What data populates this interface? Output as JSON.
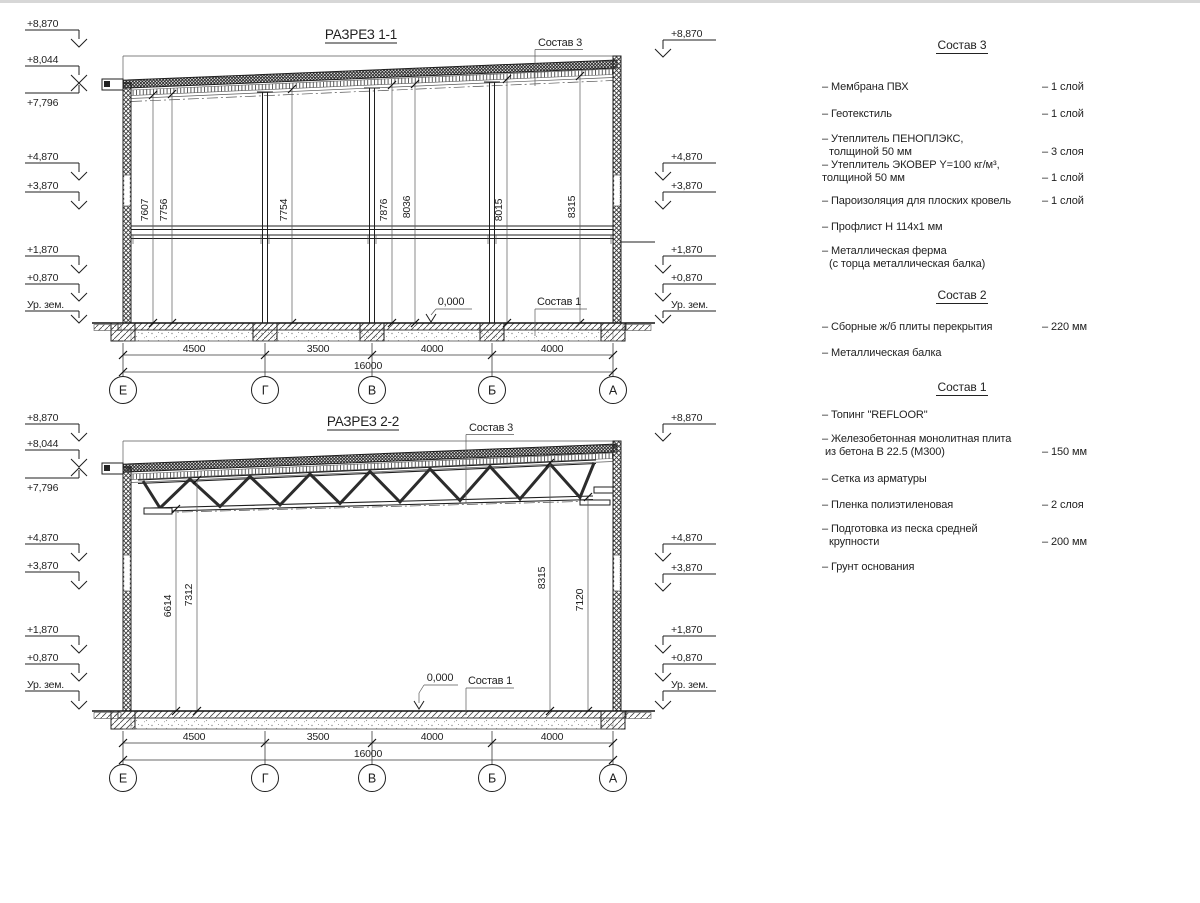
{
  "titles": {
    "s1": "РАЗРЕЗ 1-1",
    "s2": "РАЗРЕЗ 2-2"
  },
  "callouts": {
    "sostav3": "Состав 3",
    "sostav1": "Состав 1",
    "zero": "0,000"
  },
  "elev": {
    "left": [
      "+8,870",
      "+8,044",
      "+7,796",
      "+4,870",
      "+3,870",
      "+1,870",
      "+0,870",
      "Ур. зем."
    ],
    "right": [
      "+8,870",
      "+4,870",
      "+3,870",
      "+1,870",
      "+0,870",
      "Ур. зем."
    ]
  },
  "axes": [
    "Е",
    "Г",
    "В",
    "Б",
    "А"
  ],
  "dims": {
    "spans": [
      "4500",
      "3500",
      "4000",
      "4000"
    ],
    "total": "16000"
  },
  "s1": {
    "vdims": [
      "7607",
      "7756",
      "7754",
      "7876",
      "8036",
      "8015",
      "8315"
    ]
  },
  "s2": {
    "vdims": [
      "6614",
      "7312",
      "8315",
      "7120"
    ]
  },
  "legend": {
    "s3": {
      "title": "Состав 3",
      "items": [
        {
          "name": "– Мембрана ПВХ",
          "value": "– 1 слой"
        },
        {
          "name": "– Геотекстиль",
          "value": "– 1 слой"
        },
        {
          "name": "– Утеплитель ПЕНОПЛЭКС,",
          "name2": "толщиной 50 мм",
          "value": "– 3 слоя"
        },
        {
          "name": "– Утеплитель ЭКОВЕР Y=100 кг/м³,",
          "name2": "толщиной 50 мм",
          "value": "– 1 слой"
        },
        {
          "name": "– Пароизоляция для плоских кровель",
          "value": "– 1 слой"
        },
        {
          "name": "– Профлист Н 114х1 мм",
          "value": ""
        },
        {
          "name": "– Металлическая ферма",
          "name2": "(с торца металлическая балка)",
          "value": ""
        }
      ]
    },
    "s2": {
      "title": "Состав 2",
      "items": [
        {
          "name": "– Сборные ж/б плиты перекрытия",
          "value": "– 220 мм"
        },
        {
          "name": "– Металлическая балка",
          "value": ""
        }
      ]
    },
    "s1": {
      "title": "Состав 1",
      "items": [
        {
          "name": "– Топинг \"REFLOOR\"",
          "value": ""
        },
        {
          "name": "– Железобетонная  монолитная плита",
          "name2": "из бетона В 22.5 (М300)",
          "value": "– 150 мм"
        },
        {
          "name": "– Сетка из арматуры",
          "value": ""
        },
        {
          "name": "– Пленка полиэтиленовая",
          "value": "–  2 слоя"
        },
        {
          "name": "– Подготовка из песка средней",
          "name2": "крупности",
          "value": "– 200 мм"
        },
        {
          "name": "– Грунт основания",
          "value": ""
        }
      ]
    }
  }
}
